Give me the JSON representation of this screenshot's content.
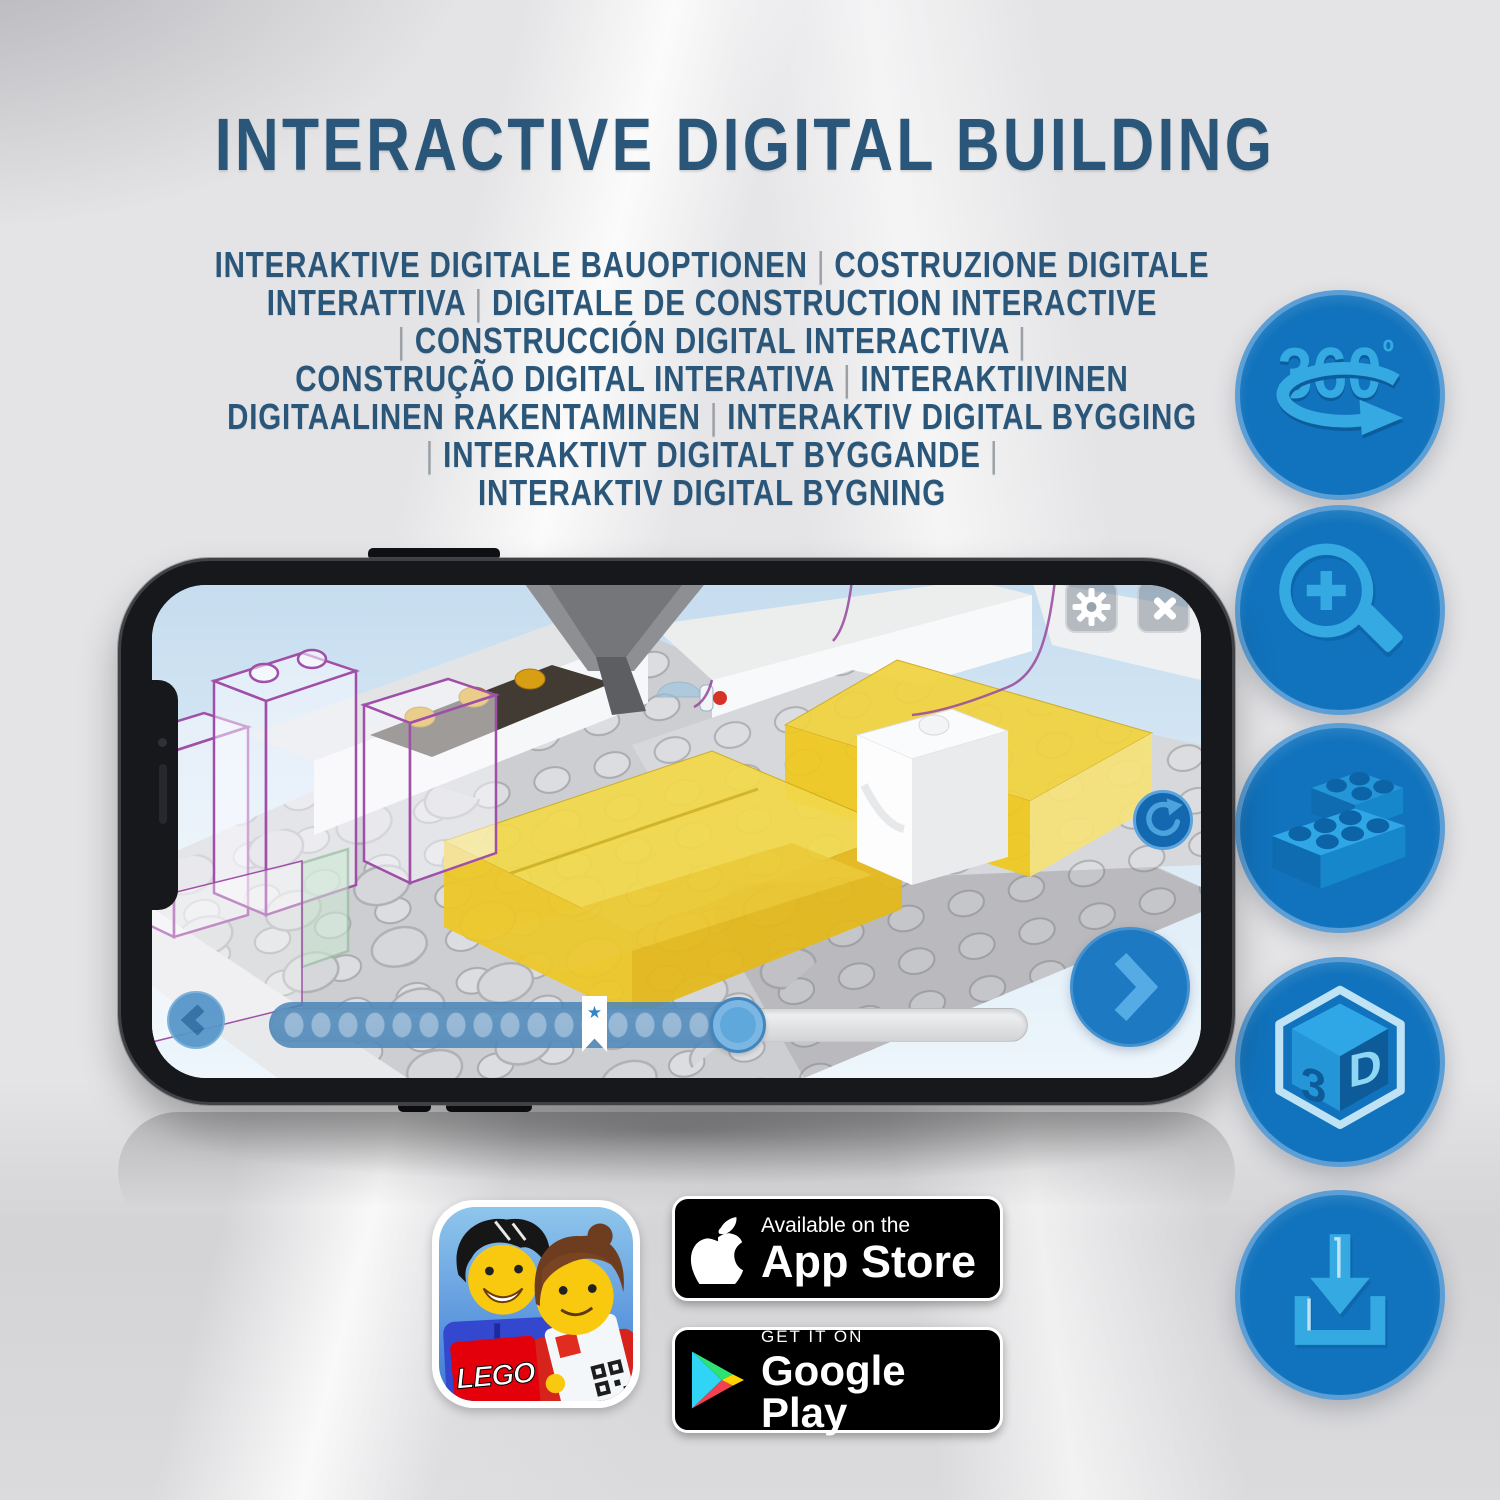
{
  "header": {
    "title": "INTERACTIVE DIGITAL BUILDING",
    "subtitle_lines": [
      "INTERAKTIVE DIGITALE BAUOPTIONEN | COSTRUZIONE DIGITALE",
      "INTERATTIVA | DIGITALE DE CONSTRUCTION INTERACTIVE",
      "| CONSTRUCCIÓN DIGITAL INTERACTIVA |",
      "CONSTRUÇÃO DIGITAL INTERATIVA | INTERAKTIIVINEN",
      "DIGITAALINEN RAKENTAMINEN | INTERAKTIV DIGITAL BYGGING",
      "| INTERAKTIVT DIGITALT BYGGANDE |",
      "INTERAKTIV DIGITAL BYGNING"
    ]
  },
  "features": [
    {
      "icon": "rotate-360-icon",
      "label": "360",
      "degree": "º"
    },
    {
      "icon": "zoom-in-icon"
    },
    {
      "icon": "lego-bricks-icon"
    },
    {
      "icon": "3d-cube-icon",
      "left_label": "3",
      "right_label": "D"
    },
    {
      "icon": "download-icon"
    }
  ],
  "phone": {
    "app_controls": {
      "settings": "gear-icon",
      "close": "close-icon",
      "rotate": "rotate-icon",
      "previous": "chevron-left-icon",
      "next": "chevron-right-icon"
    },
    "progress": {
      "bookmark_star": "★"
    }
  },
  "badges": {
    "app_store": {
      "top_line": "Available on the",
      "bottom_line": "App Store"
    },
    "google_play": {
      "top_line": "GET IT ON",
      "bottom_line": "Google Play"
    }
  },
  "app_icon": {
    "logo_text": "LEGO"
  },
  "colors": {
    "title_blue": "#2a5679",
    "separator_gray": "#9aa0a5",
    "circle_fill": "#1173bd",
    "circle_rim": "#5b9fd6",
    "glyph_blue": "#2fa7e6",
    "app_button_blue": "#1d79c2",
    "yellow_brick": "#f2d94b",
    "ghost_outline_purple": "#a04fa8",
    "lego_logo_red": "#e3000b",
    "badge_black": "#000000"
  }
}
